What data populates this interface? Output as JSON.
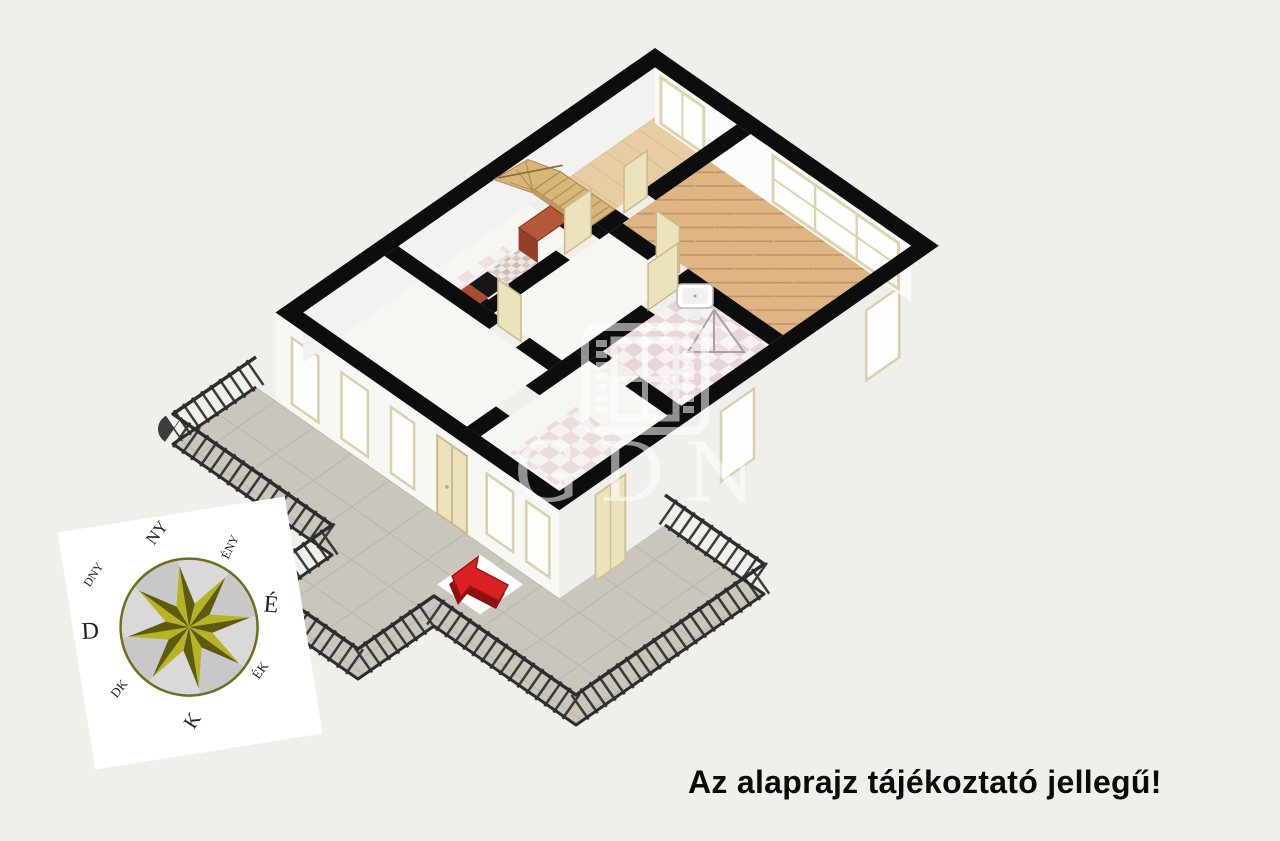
{
  "scene": {
    "background": "#f1efe9",
    "width": 1280,
    "height": 841
  },
  "disclaimer": {
    "text": "Az alaprajz tájékoztató jellegű!",
    "color": "#0a0a0a"
  },
  "watermark": {
    "text": "GDN",
    "color": "rgba(255,255,255,0.55)"
  },
  "compass": {
    "north": "É",
    "northeast": "ÉK",
    "east": "K",
    "southeast": "DK",
    "south": "D",
    "southwest": "DNY",
    "west": "NY",
    "northwest": "ÉNY",
    "star_light": "#b6b324",
    "star_dark": "#5e5b0e",
    "ring_color": "#6f6e1d",
    "label_color": "#1d1d1d"
  },
  "colors": {
    "wall": "#0d0d0d",
    "facade_sw": "#f7f7f4",
    "facade_se": "#efefec",
    "inner_wall_nw": "#f2f2f0",
    "inner_wall_ne": "#fbfbf9",
    "floor_wood": "#e7cda4",
    "floor_parquet": "#dfb584",
    "floor_white": "#f7f6f3",
    "terrace": "#cac5bd",
    "railing": "#2c2c2c",
    "cabinet": "#a84c30",
    "cabinet_dark": "#93402a",
    "cabinet_light": "#b4573a",
    "stove": "#161616",
    "stairs": "#d8b678",
    "door": "#ece3bd",
    "window_frame": "#ddd3ac",
    "glass": "#fdfdfc",
    "arrow": "#da2020",
    "arrow_dark": "#8f1010",
    "marker_tile": "#ffffff"
  }
}
